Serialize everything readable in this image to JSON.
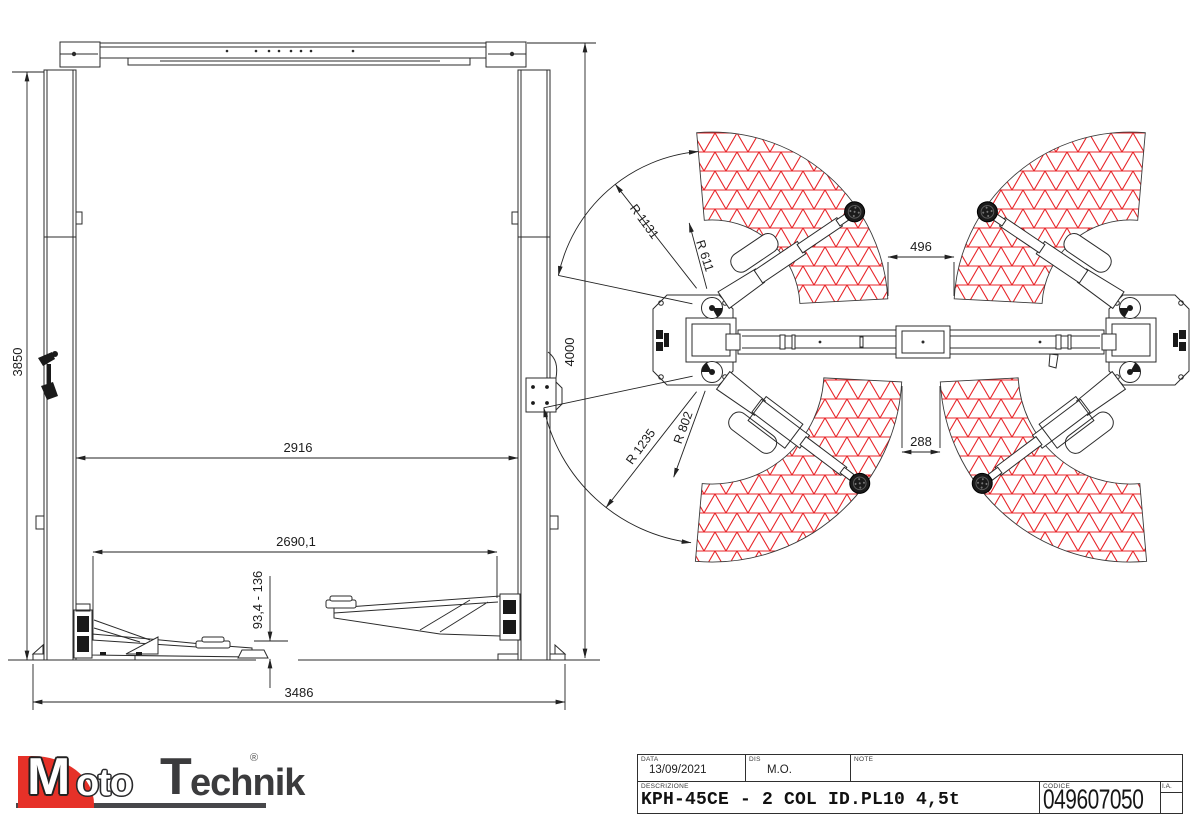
{
  "front_view": {
    "post_height": "3850",
    "overall_height": "4000",
    "inner_width": "2916",
    "arm_span": "2690,1",
    "pad_height_range": "93,4 - 136",
    "base_width": "3486"
  },
  "top_view": {
    "front_clearance": "496",
    "rear_clearance": "288",
    "front_arm_outer_radius": "R 1131",
    "front_arm_inner_radius": "R 611",
    "rear_arm_outer_radius": "R 1235",
    "rear_arm_inner_radius": "R 802"
  },
  "title_block": {
    "data_label": "DATA",
    "data_value": "13/09/2021",
    "dis_label": "DIS",
    "dis_value": "M.O.",
    "note_label": "NOTE",
    "note_value": "",
    "descrizione_label": "DESCRIZIONE",
    "descrizione_value": "KPH-45CE - 2 COL ID.PL10 4,5t",
    "codice_label": "CODICE",
    "codice_value": "049607050",
    "ia_label": "I.A."
  },
  "logo": {
    "word_m": "M",
    "word_oto": "oto",
    "word_t": "T",
    "word_echnik": "echnik",
    "registered": "®"
  },
  "colors": {
    "hatch_red": "#e8262a",
    "line": "#2b2b2b",
    "logo_red": "#e63128",
    "logo_gray": "#3b3b3d"
  }
}
